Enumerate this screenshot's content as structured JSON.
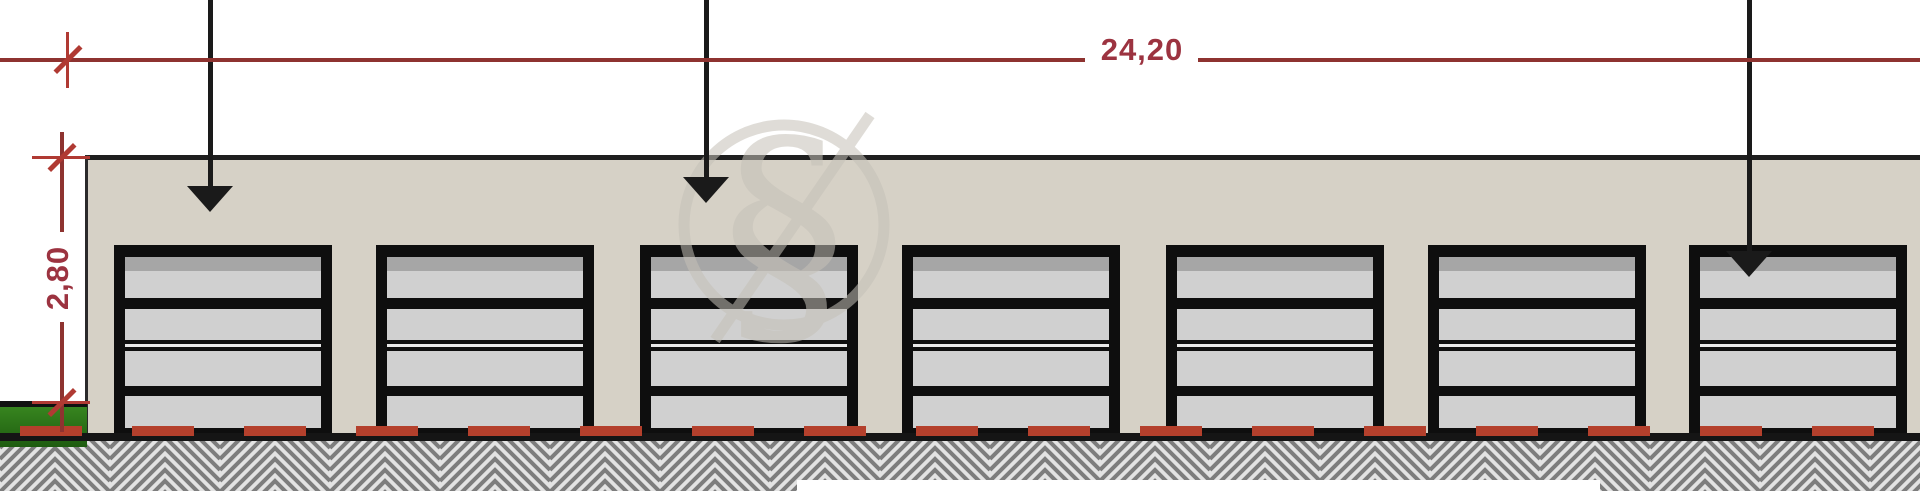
{
  "drawing": {
    "type": "architectural-elevation-garages",
    "annotations": {
      "width_dimension": "24,20",
      "height_dimension": "2,80"
    },
    "watermark": {
      "glyph": "§"
    },
    "building": {
      "door_count": 7,
      "door_lefts": [
        114,
        376,
        640,
        902,
        1166,
        1428,
        1689
      ],
      "door_width": 218,
      "door_height": 193,
      "door_top": 245
    },
    "leader_arrows": [
      {
        "x": 210,
        "tip_y": 212
      },
      {
        "x": 706,
        "tip_y": 203
      },
      {
        "x": 1749,
        "tip_y": 277
      }
    ],
    "colors": {
      "facade": "#d6d1c6",
      "dimension_red": "#8e3330",
      "dimension_text": "#9c3340",
      "dash_red": "#b4402c",
      "grass_green": "#2f7a1e",
      "door_frame": "#0e0e0e",
      "door_panel": "#d0d0d0",
      "hatch_line": "#7d7d7d",
      "watermark_grey": "#c5c1b8"
    }
  }
}
